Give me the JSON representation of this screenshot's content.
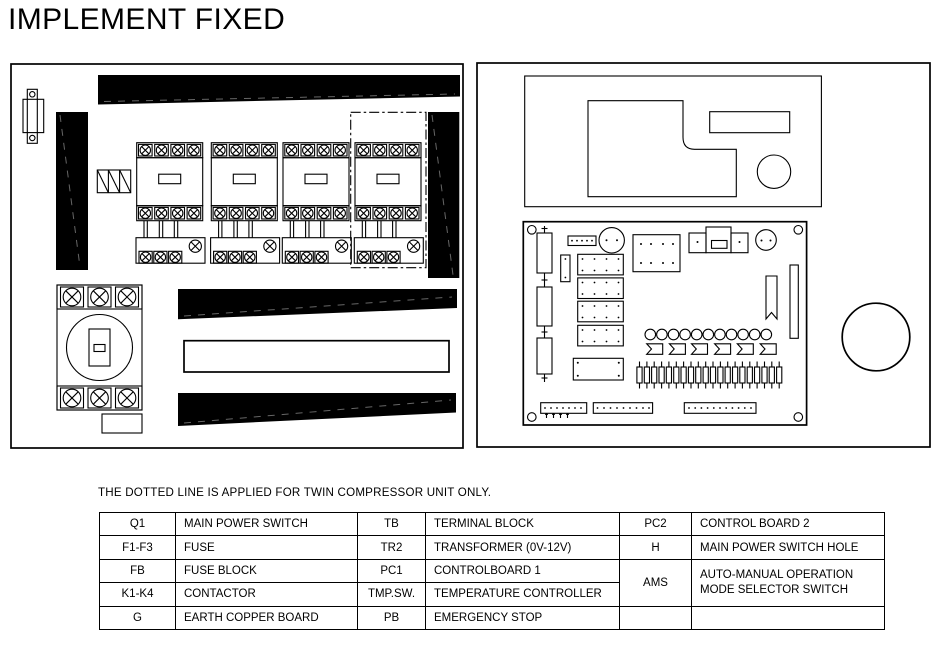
{
  "title": "IMPLEMENT FIXED",
  "note": "THE DOTTED LINE IS APPLIED FOR TWIN COMPRESSOR UNIT ONLY.",
  "colors": {
    "ink": "#000000",
    "paper": "#ffffff"
  },
  "legend_table": {
    "rows": [
      {
        "c0": "Q1",
        "c1": "MAIN POWER SWITCH",
        "c2": "TB",
        "c3": "TERMINAL BLOCK",
        "c4": "PC2",
        "c5": "CONTROL BOARD 2"
      },
      {
        "c0": "F1-F3",
        "c1": "FUSE",
        "c2": "TR2",
        "c3": "TRANSFORMER (0V-12V)",
        "c4": "H",
        "c5": "MAIN POWER SWITCH HOLE"
      },
      {
        "c0": "FB",
        "c1": "FUSE BLOCK",
        "c2": "PC1",
        "c3": "CONTROLBOARD 1",
        "c4": "AMS",
        "c5": "AUTO-MANUAL OPERATION MODE SELECTOR SWITCH"
      },
      {
        "c0": "K1-K4",
        "c1": "CONTACTOR",
        "c2": "TMP.SW.",
        "c3": "TEMPERATURE CONTROLLER"
      },
      {
        "c0": "G",
        "c1": "EARTH COPPER BOARD",
        "c2": "PB",
        "c3": "EMERGENCY STOP",
        "c4": "",
        "c5": ""
      }
    ]
  }
}
